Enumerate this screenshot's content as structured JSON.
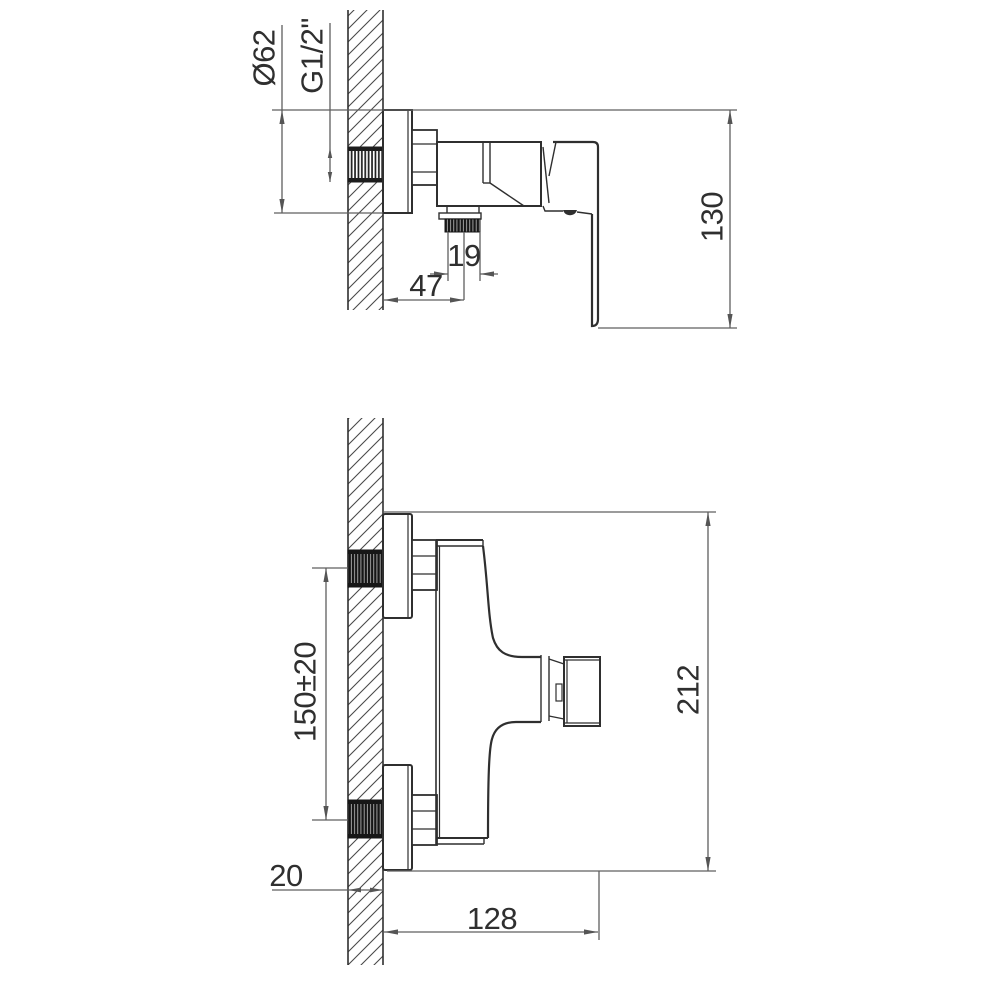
{
  "document": {
    "kind": "technical dimension drawing",
    "subject": "wall-mounted single-lever shower mixer, two orthographic views"
  },
  "colors": {
    "background": "#ffffff",
    "object_line": "#2f2f2f",
    "dimension_line": "#5f5f5f",
    "thread_fill": "#1a1a1a"
  },
  "top_view": {
    "name": "top view (plan, valve seen from above)",
    "dimensions": {
      "escutcheon_diameter": "Ø62",
      "inlet_thread": "G1/2\"",
      "wall_to_outlet_center": "47",
      "outlet_width": "19",
      "overall_length": "130"
    }
  },
  "front_view": {
    "name": "side elevation (two wall connections)",
    "dimensions": {
      "connection_centers": "150±20",
      "wall_thickness": "20",
      "overall_depth": "128",
      "overall_height": "212"
    }
  }
}
